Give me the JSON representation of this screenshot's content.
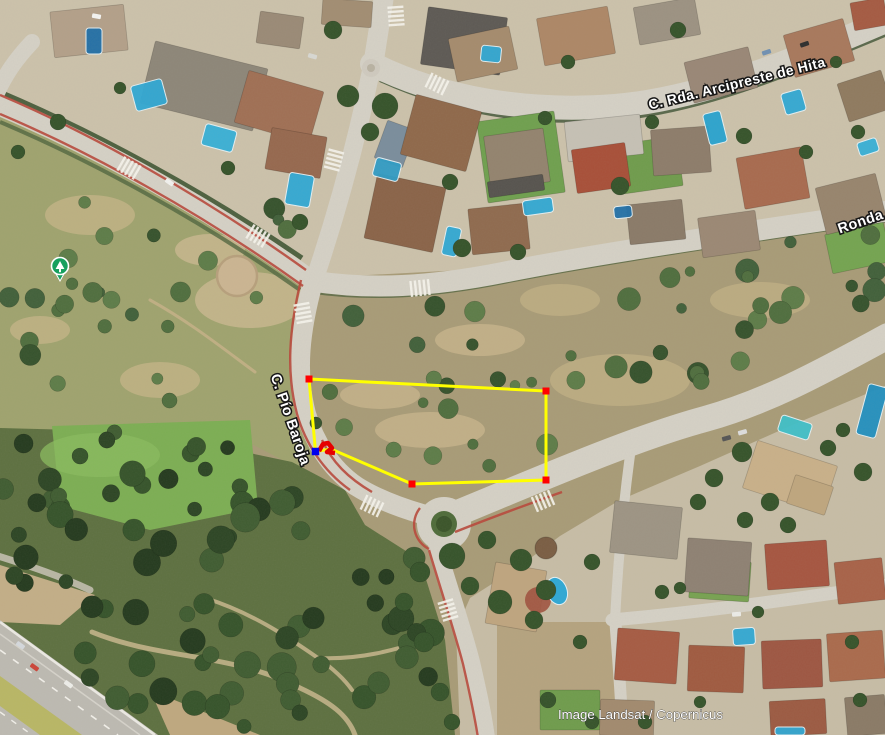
{
  "map": {
    "attribution": "Image Landsat / Copernicus",
    "street_labels": [
      {
        "id": "arcipreste",
        "text": "C. Rda. Arcipreste de Hita",
        "x": 738,
        "y": 88,
        "rotation": -13.8,
        "font_size": 14
      },
      {
        "id": "ronda",
        "text": "Ronda",
        "x": 862,
        "y": 226,
        "rotation": -19,
        "font_size": 14.5
      },
      {
        "id": "pio-baroja",
        "text": "C. Pío Baroja",
        "x": 286,
        "y": 421,
        "rotation": 71,
        "font_size": 14.5
      }
    ],
    "poi_pin": {
      "label": "park",
      "x": 60,
      "y": 266,
      "color": "#17a05e"
    },
    "annotation": {
      "type": "polygon",
      "stroke_color": "#ffff00",
      "stroke_width": 3,
      "vertex_color": "#ff0000",
      "selected_vertex_color": "#0000ee",
      "scribble_color": "#e60000",
      "vertices": [
        {
          "x": 315.5,
          "y": 451.5,
          "selected": true,
          "marker": true
        },
        {
          "x": 309,
          "y": 379,
          "selected": false,
          "marker": true
        },
        {
          "x": 546,
          "y": 391,
          "selected": false,
          "marker": true
        },
        {
          "x": 546,
          "y": 480,
          "selected": false,
          "marker": true
        },
        {
          "x": 412,
          "y": 484,
          "selected": false,
          "marker": true
        },
        {
          "x": 331,
          "y": 449,
          "selected": false,
          "marker": false
        }
      ],
      "scribble_points": [
        [
          319,
          451
        ],
        [
          323,
          444
        ],
        [
          328,
          443
        ],
        [
          332,
          448
        ],
        [
          327,
          452
        ],
        [
          335,
          453
        ]
      ]
    },
    "colors": {
      "road": "#d5d1c6",
      "scrub": "#a89b77",
      "forest": "#5d7040",
      "residential": "#ccc2ab",
      "pool": "#2fa8d5",
      "bike_lane": "#b8473a",
      "lawn": "#7cae53"
    }
  }
}
